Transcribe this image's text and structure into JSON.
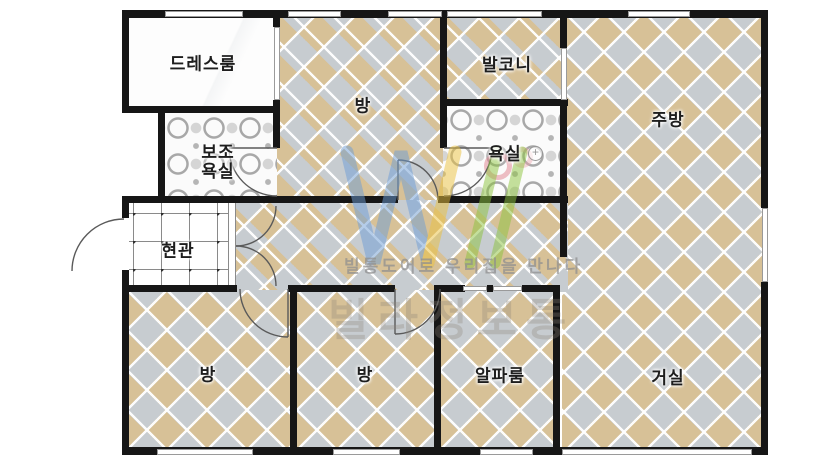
{
  "floorplan": {
    "rooms": {
      "dress_room": "드레스룸",
      "room_top": "방",
      "balcony": "발코니",
      "kitchen": "주방",
      "aux_bath_line1": "보조",
      "aux_bath_line2": "욕실",
      "bathroom": "욕실",
      "entrance": "현관",
      "room_bottom_left": "방",
      "room_bottom_mid": "방",
      "alpha_room": "알파룸",
      "living_room": "거실"
    },
    "watermark": {
      "tagline": "빌통도어로 우리집을 만나다",
      "brand": "빌라정보통"
    },
    "icons": {
      "sink_icon_glyph": "+"
    },
    "colors": {
      "wall": "#161616",
      "tile_tan": "#d7c197",
      "tile_gray": "#c7ccd0",
      "logo_blue": "#6f9ed6",
      "logo_yellow": "#ecc23f",
      "logo_green": "#8cc43e"
    }
  }
}
